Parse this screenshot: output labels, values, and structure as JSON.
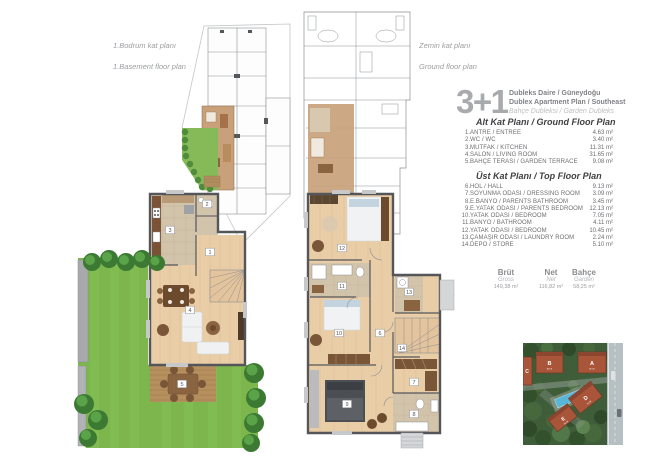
{
  "top_plans": {
    "basement": {
      "label_tr": "1.Bodrum kat planı",
      "label_en": "1.Basement floor plan"
    },
    "ground": {
      "label_tr": "Zemin kat planı",
      "label_en": "Ground floor plan"
    }
  },
  "unit_panel": {
    "type_label": "3+1",
    "title_tr": "Dubleks Daire / Güneydoğu",
    "title_en": "Dublex Apartment Plan / Southeast",
    "subtitle": "Bahçe Dubleksi / Garden Dubleks",
    "lower_floor": {
      "heading": "Alt Kat Planı / Ground Floor Plan",
      "rooms": [
        {
          "no": "1",
          "name": "ANTRE / ENTREE",
          "area": "4.63 m²"
        },
        {
          "no": "2",
          "name": "WC / WC",
          "area": "3.40 m²"
        },
        {
          "no": "3",
          "name": "MUTFAK / KITCHEN",
          "area": "11.31 m²"
        },
        {
          "no": "4",
          "name": "SALON / LIVING ROOM",
          "area": "31.65 m²"
        },
        {
          "no": "5",
          "name": "BAHÇE TERASI / GARDEN TERRACE",
          "area": "9.08 m²"
        }
      ]
    },
    "upper_floor": {
      "heading": "Üst Kat Planı / Top Floor Plan",
      "rooms": [
        {
          "no": "6",
          "name": "HOL / HALL",
          "area": "9.13 m²"
        },
        {
          "no": "7",
          "name": "SOYUNMA ODASI / DRESSING ROOM",
          "area": "3.09 m²"
        },
        {
          "no": "8",
          "name": "E.BANYO / PARENTS BATHROOM",
          "area": "3.45 m²"
        },
        {
          "no": "9",
          "name": "E.YATAK ODASI / PARENTS BEDROOM",
          "area": "12.13 m²"
        },
        {
          "no": "10",
          "name": "YATAK ODASI / BEDROOM",
          "area": "7.05 m²"
        },
        {
          "no": "11",
          "name": "BANYO / BATHROOM",
          "area": "4.11 m²"
        },
        {
          "no": "12",
          "name": "YATAK ODASI / BEDROOM",
          "area": "10.45 m²"
        },
        {
          "no": "13",
          "name": "ÇAMAŞIR ODASI / LAUNDRY ROOM",
          "area": "2.24 m²"
        },
        {
          "no": "14",
          "name": "DEPO / STORE",
          "area": "5.10 m²"
        }
      ]
    },
    "summary": [
      {
        "label": "Brüt",
        "sub": "Gross",
        "value": "149,38 m²"
      },
      {
        "label": "Net",
        "sub": "Net",
        "value": "116,82 m²"
      },
      {
        "label": "Bahçe",
        "sub": "Garden",
        "value": "58,25 m²"
      }
    ]
  },
  "floor_markers": {
    "ground": [
      "1",
      "2",
      "3",
      "4",
      "5"
    ],
    "top": [
      "6",
      "7",
      "8",
      "9",
      "10",
      "11",
      "12",
      "13",
      "14"
    ]
  },
  "site_plan": {
    "blocks": [
      {
        "label": "A",
        "sub": "BLOK"
      },
      {
        "label": "B",
        "sub": "BLOK"
      },
      {
        "label": "C",
        "sub": "BLOK"
      },
      {
        "label": "D",
        "sub": "BLOK"
      },
      {
        "label": "E",
        "sub": "BLOK"
      }
    ]
  },
  "colors": {
    "accent_tan": "#c8a17a",
    "grass": "#7cb64c",
    "wall": "#55565a",
    "terracotta": "#a9553a",
    "text_gray": "#6d6e71"
  }
}
